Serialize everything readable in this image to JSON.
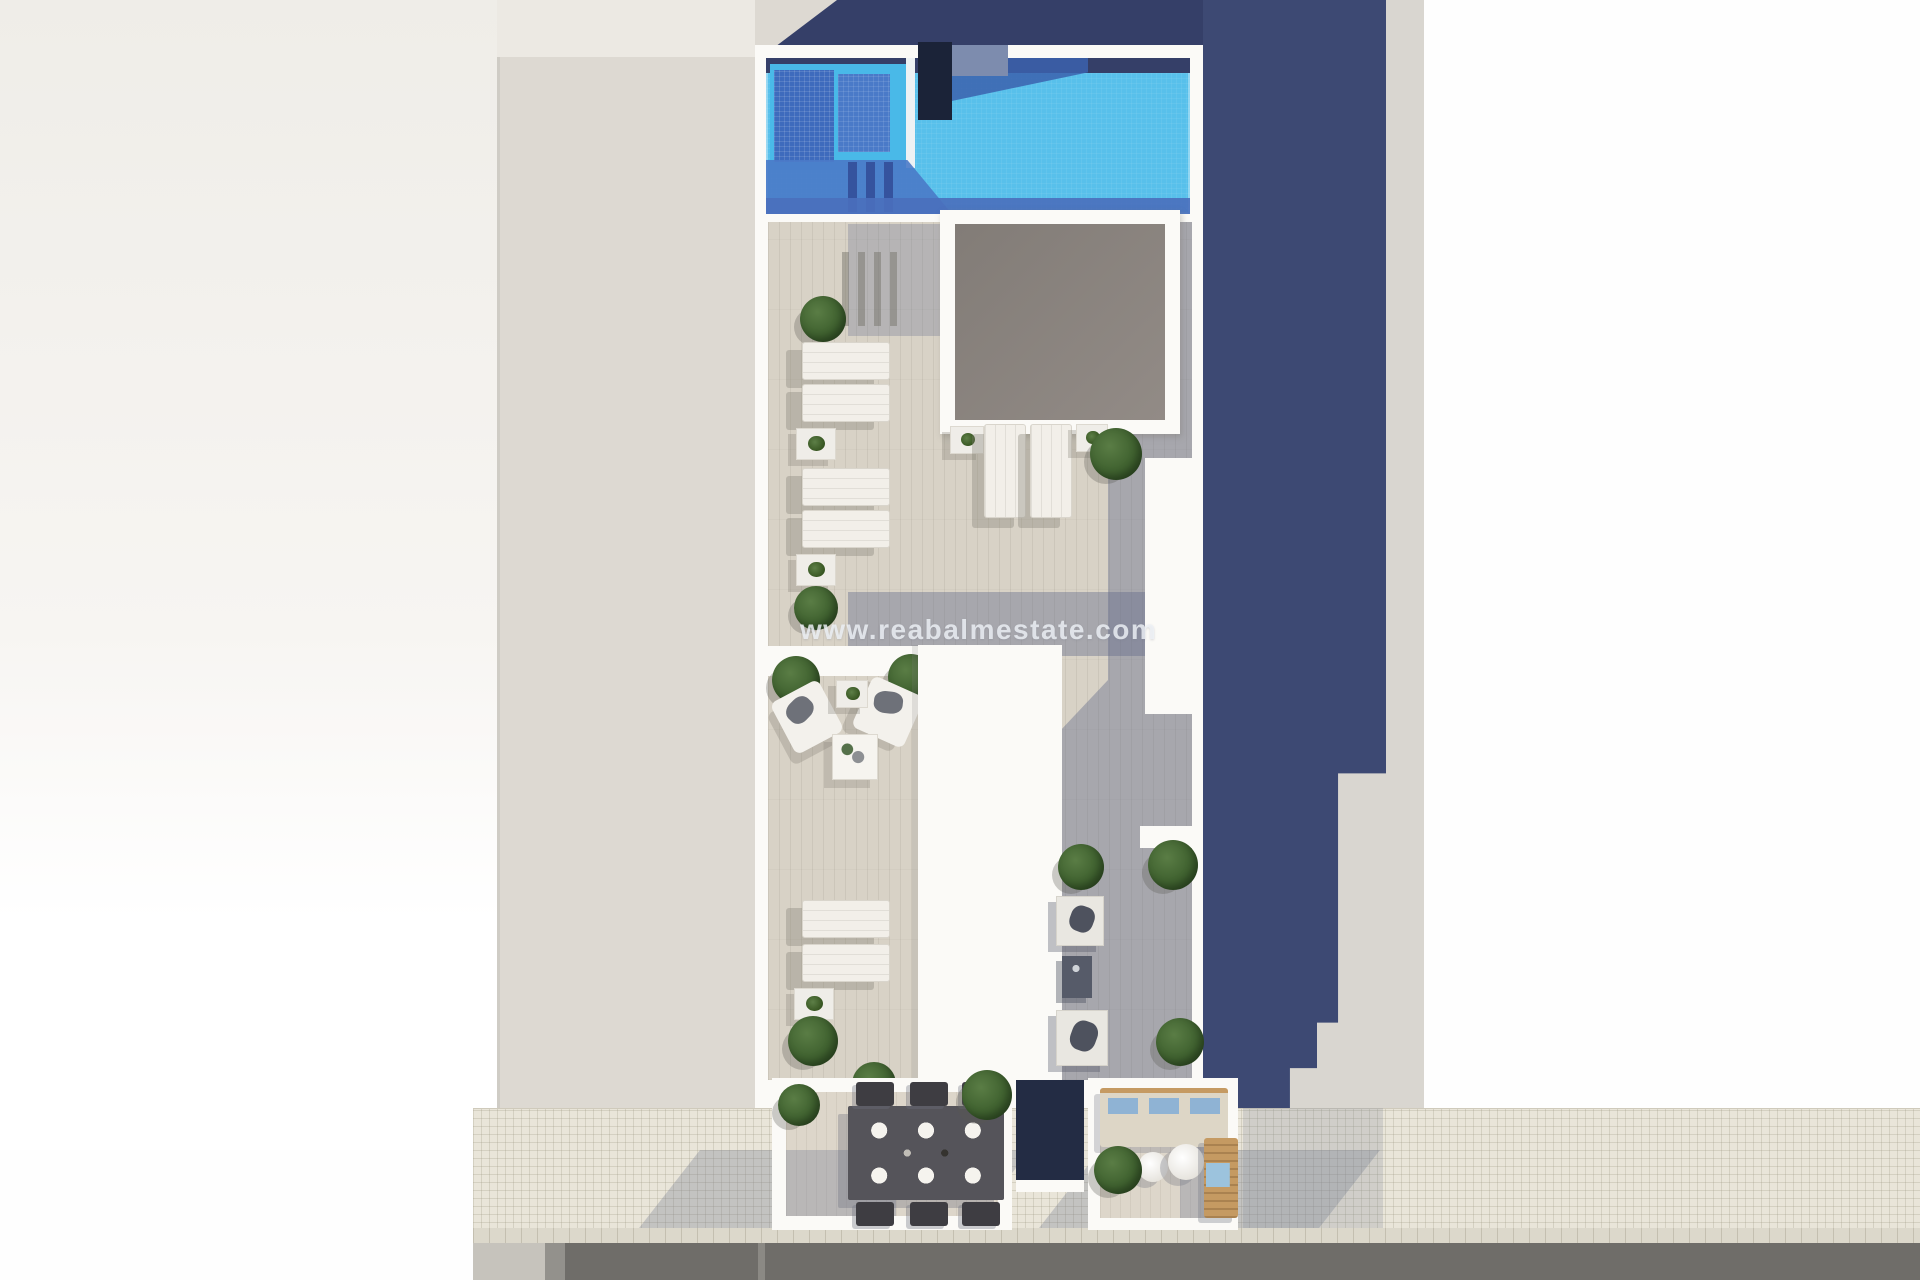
{
  "watermark": {
    "text": "www.reabalmestate.com"
  },
  "palette": {
    "navy": "#3d4973",
    "navy_dark": "#353f68",
    "pool_cyan": "#58c0eb",
    "pool_mid": "#4a7ac8",
    "pool_dark": "#3e6bbd",
    "wall": "#fbfaf7",
    "deck": "#d8d2c6",
    "deck_shade": "rgba(95,103,135,0.40)",
    "skylight": "#928b86",
    "passage": "#ddd9d2",
    "sidewalk": "#e9e5d9",
    "road": "#6f6d69",
    "bush": "#3f612f",
    "wood": "#c59a62",
    "cushion": "#8fb3d4",
    "sofa": "#ddd6c6",
    "table_dark": "#55545a",
    "watermark": "rgba(238,241,246,0.82)"
  },
  "scene": [
    {
      "name": "neighbor-roof-left",
      "cls": "leftlight",
      "x": 0,
      "y": 0,
      "w": 500,
      "h": 1150
    },
    {
      "name": "side-passage-parapet",
      "cls": "passage-top",
      "x": 497,
      "y": 0,
      "w": 258,
      "h": 57
    },
    {
      "name": "side-passage-ground",
      "cls": "passage",
      "x": 497,
      "y": 57,
      "w": 258,
      "h": 1093
    },
    {
      "name": "side-passage-edge",
      "cls": "edge",
      "x": 497,
      "y": 57,
      "w": 3,
      "h": 1093
    },
    {
      "name": "neighbor-ground-right-sunlit",
      "cls": "graystrip",
      "x": 1203,
      "y": 0,
      "w": 221,
      "h": 1110
    },
    {
      "name": "sidewalk",
      "cls": "sidewalk",
      "x": 473,
      "y": 1108,
      "w": 1447,
      "h": 122
    },
    {
      "name": "curb-tiles",
      "cls": "curb",
      "x": 473,
      "y": 1228,
      "w": 1447,
      "h": 16
    },
    {
      "name": "road",
      "cls": "road",
      "x": 473,
      "y": 1243,
      "w": 1447,
      "h": 37
    },
    {
      "name": "road-patch",
      "cls": "road-patch",
      "x": 473,
      "y": 1243,
      "w": 72,
      "h": 37
    },
    {
      "name": "road-strip",
      "cls": "road-strip",
      "x": 545,
      "y": 1243,
      "w": 20,
      "h": 37
    },
    {
      "name": "road-marking",
      "cls": "road-line",
      "x": 758,
      "y": 1243,
      "w": 7,
      "h": 37
    },
    {
      "name": "terrace-shadow-on-sidewalk-left",
      "cls": "walkshadow",
      "x": 700,
      "y": 1150,
      "w": 330,
      "h": 78
    },
    {
      "name": "terrace-shadow-on-sidewalk-right",
      "cls": "walkshadow",
      "x": 1100,
      "y": 1150,
      "w": 280,
      "h": 78
    },
    {
      "name": "building-shadow-on-sidewalk-corner",
      "cls": "walkshadow-soft",
      "x": 1243,
      "y": 1108,
      "w": 140,
      "h": 120
    },
    {
      "name": "building-shadow-top",
      "cls": "navy-band",
      "x": 755,
      "y": 0,
      "w": 448,
      "h": 48
    },
    {
      "name": "neighbor-corner-triangle",
      "cls": "gray-tri",
      "x": 755,
      "y": 0,
      "w": 82,
      "h": 62
    },
    {
      "name": "building-shadow-right",
      "cls": "navy-col",
      "x": 1203,
      "y": 0,
      "w": 183,
      "h": 1108
    },
    {
      "name": "building-roof-base",
      "cls": "whitewall",
      "x": 755,
      "y": 45,
      "w": 448,
      "h": 1063
    },
    {
      "name": "roof-deck",
      "cls": "deck",
      "x": 768,
      "y": 222,
      "w": 424,
      "h": 858
    },
    {
      "name": "deck-shade-right-walkway",
      "cls": "shade",
      "x": 1108,
      "y": 222,
      "w": 84,
      "h": 858
    },
    {
      "name": "deck-shade-lower",
      "cls": "shade-clip",
      "x": 1010,
      "y": 680,
      "w": 98,
      "h": 400
    },
    {
      "name": "deck-shade-mid-band",
      "cls": "shade",
      "x": 848,
      "y": 592,
      "w": 344,
      "h": 64
    },
    {
      "name": "deck-shade-below-pool",
      "cls": "shade-soft",
      "x": 848,
      "y": 224,
      "w": 112,
      "h": 112
    },
    {
      "name": "swimming-pool",
      "cls": "pool",
      "x": 766,
      "y": 58,
      "w": 424,
      "h": 156
    },
    {
      "name": "pool-edge-shadow-top",
      "cls": "pool-topband",
      "x": 766,
      "y": 58,
      "w": 424,
      "h": 15
    },
    {
      "name": "pool-shadow-wedge",
      "cls": "pool-wedge",
      "x": 928,
      "y": 58,
      "w": 160,
      "h": 48
    },
    {
      "name": "kids-pool-zone",
      "cls": "subpool",
      "x": 770,
      "y": 64,
      "w": 140,
      "h": 106
    },
    {
      "name": "kids-pool-deep",
      "cls": "pool-dark",
      "x": 774,
      "y": 70,
      "w": 60,
      "h": 92
    },
    {
      "name": "kids-pool-step",
      "cls": "pool-mid",
      "x": 838,
      "y": 74,
      "w": 52,
      "h": 78
    },
    {
      "name": "pool-divider-wall",
      "cls": "divider",
      "x": 906,
      "y": 58,
      "w": 9,
      "h": 110
    },
    {
      "name": "pool-floor-shadow",
      "cls": "pool-floor-shadow",
      "x": 766,
      "y": 160,
      "w": 186,
      "h": 54
    },
    {
      "name": "pool-ladder-step-1",
      "cls": "ladder-bar",
      "x": 848,
      "y": 162,
      "w": 9,
      "h": 50
    },
    {
      "name": "pool-ladder-step-2",
      "cls": "ladder-bar",
      "x": 866,
      "y": 162,
      "w": 9,
      "h": 50
    },
    {
      "name": "pool-ladder-step-3",
      "cls": "ladder-bar",
      "x": 884,
      "y": 162,
      "w": 9,
      "h": 50
    },
    {
      "name": "pool-edge-shadow-bottom",
      "cls": "pool-bottomband",
      "x": 766,
      "y": 198,
      "w": 424,
      "h": 16
    },
    {
      "name": "outdoor-shower-panel",
      "cls": "shower",
      "x": 918,
      "y": 42,
      "w": 34,
      "h": 78
    },
    {
      "name": "pool-wall-block",
      "cls": "bluegray",
      "x": 952,
      "y": 45,
      "w": 56,
      "h": 31
    },
    {
      "name": "railing-shadow-1",
      "cls": "rail-shadow",
      "x": 842,
      "y": 252,
      "w": 7,
      "h": 74
    },
    {
      "name": "railing-shadow-2",
      "cls": "rail-shadow",
      "x": 858,
      "y": 252,
      "w": 7,
      "h": 74
    },
    {
      "name": "railing-shadow-3",
      "cls": "rail-shadow",
      "x": 874,
      "y": 252,
      "w": 7,
      "h": 74
    },
    {
      "name": "railing-shadow-4",
      "cls": "rail-shadow",
      "x": 890,
      "y": 252,
      "w": 7,
      "h": 74
    },
    {
      "name": "skylight-frame",
      "cls": "skylight-frame",
      "x": 940,
      "y": 210,
      "w": 240,
      "h": 224
    },
    {
      "name": "skylight-glass",
      "cls": "skylight",
      "x": 955,
      "y": 224,
      "w": 210,
      "h": 196
    },
    {
      "name": "planter-bush",
      "cls": "bush",
      "x": 800,
      "y": 296,
      "s": 46
    },
    {
      "name": "sun-lounger",
      "cls": "lounger",
      "x": 802,
      "y": 342,
      "w": 86,
      "h": 36
    },
    {
      "name": "sun-lounger",
      "cls": "lounger",
      "x": 802,
      "y": 384,
      "w": 86,
      "h": 36
    },
    {
      "name": "lounger-side-table",
      "cls": "side-table",
      "x": 796,
      "y": 428,
      "w": 38,
      "h": 30
    },
    {
      "name": "sun-lounger",
      "cls": "lounger",
      "x": 802,
      "y": 468,
      "w": 86,
      "h": 36
    },
    {
      "name": "sun-lounger",
      "cls": "lounger",
      "x": 802,
      "y": 510,
      "w": 86,
      "h": 36
    },
    {
      "name": "lounger-side-table",
      "cls": "side-table",
      "x": 796,
      "y": 554,
      "w": 38,
      "h": 30
    },
    {
      "name": "planter-bush",
      "cls": "bush",
      "x": 794,
      "y": 586,
      "s": 44
    },
    {
      "name": "lounger-side-table",
      "cls": "side-table",
      "x": 950,
      "y": 426,
      "w": 32,
      "h": 26
    },
    {
      "name": "sun-lounger-vertical",
      "cls": "lounger-v",
      "x": 984,
      "y": 424,
      "w": 40,
      "h": 92
    },
    {
      "name": "sun-lounger-vertical",
      "cls": "lounger-v",
      "x": 1030,
      "y": 424,
      "w": 40,
      "h": 92
    },
    {
      "name": "lounger-side-table",
      "cls": "side-table",
      "x": 1076,
      "y": 424,
      "w": 30,
      "h": 26
    },
    {
      "name": "planter-bush",
      "cls": "bush",
      "x": 1090,
      "y": 428,
      "s": 52
    },
    {
      "name": "terrace-parapet-mid",
      "cls": "whitewall",
      "x": 768,
      "y": 646,
      "w": 164,
      "h": 30
    },
    {
      "name": "planter-bush",
      "cls": "bush",
      "x": 772,
      "y": 656,
      "s": 48
    },
    {
      "name": "planter-bush",
      "cls": "bush",
      "x": 888,
      "y": 654,
      "s": 46
    },
    {
      "name": "outdoor-armchair",
      "cls": "armchair",
      "x": 780,
      "y": 688,
      "w": 54,
      "h": 58,
      "rot": -28
    },
    {
      "name": "outdoor-armchair",
      "cls": "armchair",
      "x": 860,
      "y": 684,
      "w": 56,
      "h": 56,
      "rot": 24
    },
    {
      "name": "lounger-side-table",
      "cls": "side-table",
      "x": 836,
      "y": 680,
      "w": 30,
      "h": 26
    },
    {
      "name": "coffee-table",
      "cls": "coffee-table",
      "x": 832,
      "y": 734,
      "w": 44,
      "h": 44
    },
    {
      "name": "stair-bulkhead-roof",
      "cls": "slab",
      "x": 918,
      "y": 645,
      "w": 144,
      "h": 436
    },
    {
      "name": "rooftop-volume-right",
      "cls": "whitewall",
      "x": 1145,
      "y": 458,
      "w": 50,
      "h": 256
    },
    {
      "name": "wall-step-right",
      "cls": "whitewall",
      "x": 1140,
      "y": 826,
      "w": 54,
      "h": 22
    },
    {
      "name": "daybed",
      "cls": "daybed",
      "x": 1056,
      "y": 896,
      "w": 46,
      "h": 48
    },
    {
      "name": "patio-side-table",
      "cls": "dark-table",
      "x": 1062,
      "y": 956,
      "w": 30,
      "h": 42
    },
    {
      "name": "daybed",
      "cls": "daybed",
      "x": 1056,
      "y": 1010,
      "w": 50,
      "h": 54
    },
    {
      "name": "planter-bush",
      "cls": "bush",
      "x": 1058,
      "y": 844,
      "s": 46
    },
    {
      "name": "planter-bush",
      "cls": "bush",
      "x": 1148,
      "y": 840,
      "s": 50
    },
    {
      "name": "planter-bush",
      "cls": "bush",
      "x": 1156,
      "y": 1018,
      "s": 48
    },
    {
      "name": "wood-planter-box",
      "cls": "wood-planter",
      "x": 1126,
      "y": 1166,
      "w": 64,
      "h": 50
    },
    {
      "name": "sun-lounger",
      "cls": "lounger",
      "x": 802,
      "y": 900,
      "w": 86,
      "h": 36
    },
    {
      "name": "sun-lounger",
      "cls": "lounger",
      "x": 802,
      "y": 944,
      "w": 86,
      "h": 36
    },
    {
      "name": "lounger-side-table",
      "cls": "side-table",
      "x": 794,
      "y": 988,
      "w": 38,
      "h": 30
    },
    {
      "name": "planter-bush",
      "cls": "bush",
      "x": 788,
      "y": 1016,
      "s": 50
    },
    {
      "name": "planter-bush",
      "cls": "bush",
      "x": 852,
      "y": 1062,
      "s": 44
    },
    {
      "name": "balcony-dining",
      "cls": "whitewall",
      "x": 772,
      "y": 1078,
      "w": 240,
      "h": 152
    },
    {
      "name": "balcony-dining-floor",
      "cls": "terrace-floor",
      "x": 786,
      "y": 1092,
      "w": 212,
      "h": 124
    },
    {
      "name": "balcony-dining-shadow",
      "cls": "shade-soft",
      "x": 786,
      "y": 1150,
      "w": 110,
      "h": 66
    },
    {
      "name": "dining-table",
      "cls": "dining-table",
      "x": 848,
      "y": 1106,
      "w": 156,
      "h": 94
    },
    {
      "name": "dining-chair",
      "cls": "chair",
      "x": 856,
      "y": 1082,
      "w": 38,
      "h": 24
    },
    {
      "name": "dining-chair",
      "cls": "chair",
      "x": 910,
      "y": 1082,
      "w": 38,
      "h": 24
    },
    {
      "name": "dining-chair",
      "cls": "chair",
      "x": 962,
      "y": 1082,
      "w": 38,
      "h": 24
    },
    {
      "name": "dining-chair",
      "cls": "chair",
      "x": 856,
      "y": 1202,
      "w": 38,
      "h": 24
    },
    {
      "name": "dining-chair",
      "cls": "chair",
      "x": 910,
      "y": 1202,
      "w": 38,
      "h": 24
    },
    {
      "name": "dining-chair",
      "cls": "chair",
      "x": 962,
      "y": 1202,
      "w": 38,
      "h": 24
    },
    {
      "name": "planter-bush",
      "cls": "bush",
      "x": 778,
      "y": 1084,
      "s": 42
    },
    {
      "name": "planter-bush",
      "cls": "bush",
      "x": 962,
      "y": 1070,
      "s": 50
    },
    {
      "name": "balcony-gap-void",
      "cls": "void",
      "x": 1016,
      "y": 1080,
      "w": 68,
      "h": 100
    },
    {
      "name": "balcony-gap-sill",
      "cls": "whitewall",
      "x": 1016,
      "y": 1180,
      "w": 68,
      "h": 12
    },
    {
      "name": "balcony-lounge",
      "cls": "whitewall",
      "x": 1088,
      "y": 1078,
      "w": 150,
      "h": 152
    },
    {
      "name": "balcony-lounge-floor",
      "cls": "terrace-floor",
      "x": 1100,
      "y": 1090,
      "w": 126,
      "h": 128
    },
    {
      "name": "balcony-lounge-shadow",
      "cls": "shade-soft",
      "x": 1180,
      "y": 1090,
      "w": 46,
      "h": 128
    },
    {
      "name": "outdoor-sofa",
      "cls": "sofa",
      "x": 1100,
      "y": 1088,
      "w": 128,
      "h": 54
    },
    {
      "name": "round-coffee-table",
      "cls": "round-table",
      "x": 1138,
      "y": 1152,
      "s": 30
    },
    {
      "name": "round-coffee-table",
      "cls": "round-table",
      "x": 1168,
      "y": 1144,
      "s": 36
    },
    {
      "name": "planter-bush",
      "cls": "bush",
      "x": 1094,
      "y": 1146,
      "s": 48
    },
    {
      "name": "wooden-lounger",
      "cls": "wood-lounger",
      "x": 1204,
      "y": 1138,
      "w": 34,
      "h": 80
    }
  ]
}
